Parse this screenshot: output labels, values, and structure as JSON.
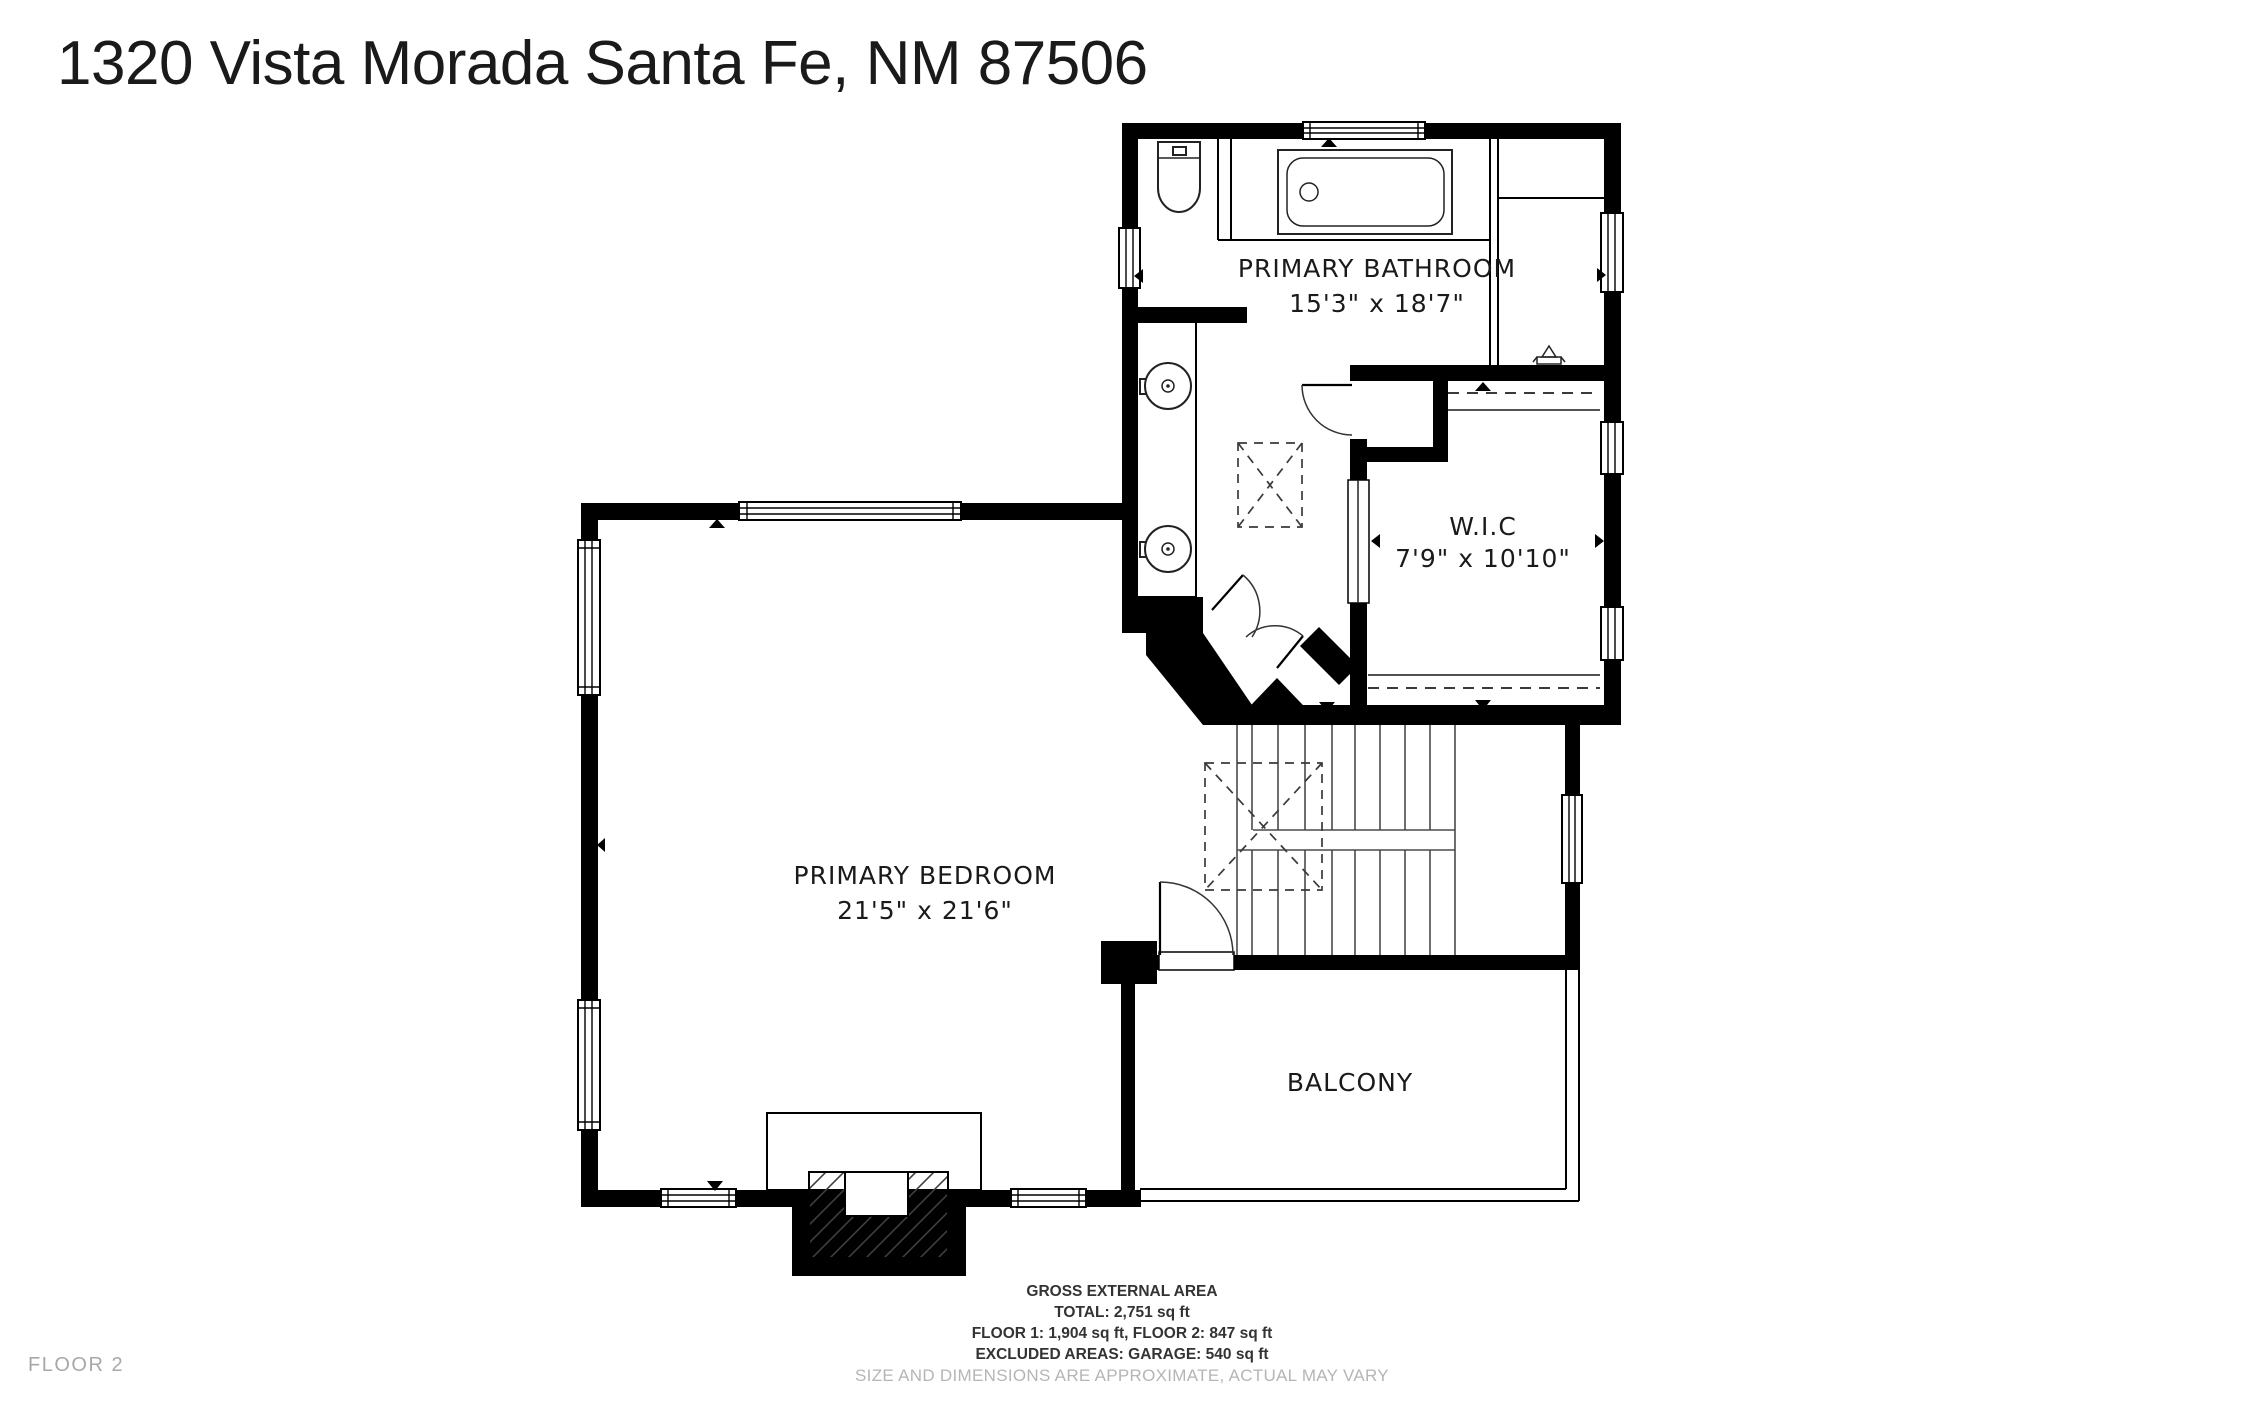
{
  "title": "1320 Vista Morada Santa Fe, NM 87506",
  "floor_label": "FLOOR 2",
  "rooms": {
    "primary_bathroom": {
      "label": "PRIMARY BATHROOM",
      "dimensions": "15'3\" x 18'7\""
    },
    "wic": {
      "label": "W.I.C",
      "dimensions": "7'9\" x 10'10\""
    },
    "primary_bedroom": {
      "label": "PRIMARY BEDROOM",
      "dimensions": "21'5\" x 21'6\""
    },
    "balcony": {
      "label": "BALCONY"
    }
  },
  "footer": {
    "area_heading": "GROSS EXTERNAL AREA",
    "total": "TOTAL: 2,751 sq ft",
    "floors": "FLOOR 1: 1,904 sq ft, FLOOR 2: 847 sq ft",
    "excluded": "EXCLUDED AREAS: GARAGE: 540 sq ft",
    "disclaimer": "SIZE AND DIMENSIONS ARE APPROXIMATE, ACTUAL MAY VARY"
  },
  "colors": {
    "wall": "#000000",
    "background": "#ffffff",
    "room_label": "#1a1a1a",
    "footer_text": "#333333",
    "muted_text": "#b5b5b5",
    "floor_label": "#a8a8a8"
  }
}
